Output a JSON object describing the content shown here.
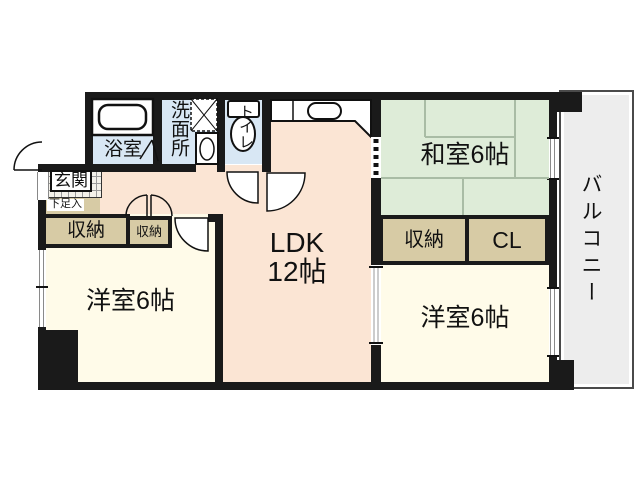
{
  "floorplan": {
    "labels": {
      "bath": "浴室",
      "washroom": "洗面所",
      "toilet": "トイレ",
      "entrance": "玄関",
      "shoe_storage": "下足入",
      "storage_hall_large": "収納",
      "storage_hall_small": "収納",
      "ldk_name": "LDK",
      "ldk_size": "12帖",
      "japanese_room": "和室6帖",
      "storage_right": "収納",
      "closet": "CL",
      "western_room_left": "洋室6帖",
      "western_room_right": "洋室6帖",
      "balcony": "バルコニー"
    },
    "colors": {
      "wall": "#1a1a1a",
      "ldk_floor": "#fbe5d4",
      "tatami_floor": "#deecd8",
      "western_floor": "#fffbe9",
      "storage_fill": "#d7cba5",
      "wet_area_fill": "#d8e7f4",
      "balcony_fill": "#ededed",
      "tatami_line": "#a9bca5"
    },
    "icons": {
      "bathtub": "bathtub-icon",
      "washing_machine_pan": "washing-machine-pan-icon",
      "vanity_sink": "vanity-sink-icon",
      "toilet_bowl": "toilet-icon",
      "kitchen_counter": "kitchen-counter-icon",
      "door_swing": "door-swing-icon",
      "double_door": "double-door-icon",
      "sliding_door": "sliding-door-icon",
      "window": "window-icon"
    }
  }
}
